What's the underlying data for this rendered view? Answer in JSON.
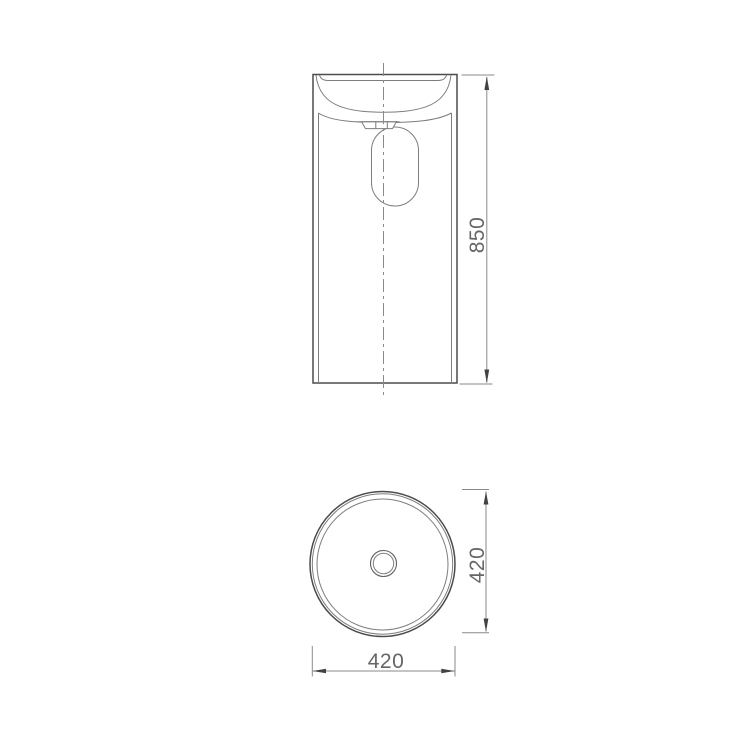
{
  "page": {
    "background": "#ffffff"
  },
  "drawing": {
    "kind": "technical-dimension-drawing",
    "subject": "round-freestanding-pedestal-basin",
    "colors": {
      "outline": "#4c4c4c",
      "detail_line": "#7d7d7d",
      "dimension_line": "#8a8a8a",
      "arrow": "#424242",
      "text": "#666666",
      "background": "#ffffff"
    },
    "views": {
      "front": {
        "name": "front-elevation",
        "features": [
          "basin-bowl",
          "drain-fitting",
          "bottle-trap",
          "pedestal-body",
          "vertical-centerline"
        ],
        "dimensions": [
          {
            "id": "overall-height",
            "label": "850",
            "value": 850,
            "orientation": "vertical",
            "side": "right"
          }
        ]
      },
      "top": {
        "name": "top-plan",
        "features": [
          "outer-rim-circle",
          "rim-inner-circle",
          "bowl-circle",
          "drain-circle"
        ],
        "dimensions": [
          {
            "id": "diameter-vertical",
            "label": "420",
            "value": 420,
            "orientation": "vertical",
            "side": "right"
          },
          {
            "id": "diameter-horizontal",
            "label": "420",
            "value": 420,
            "orientation": "horizontal",
            "side": "bottom"
          }
        ]
      }
    }
  }
}
